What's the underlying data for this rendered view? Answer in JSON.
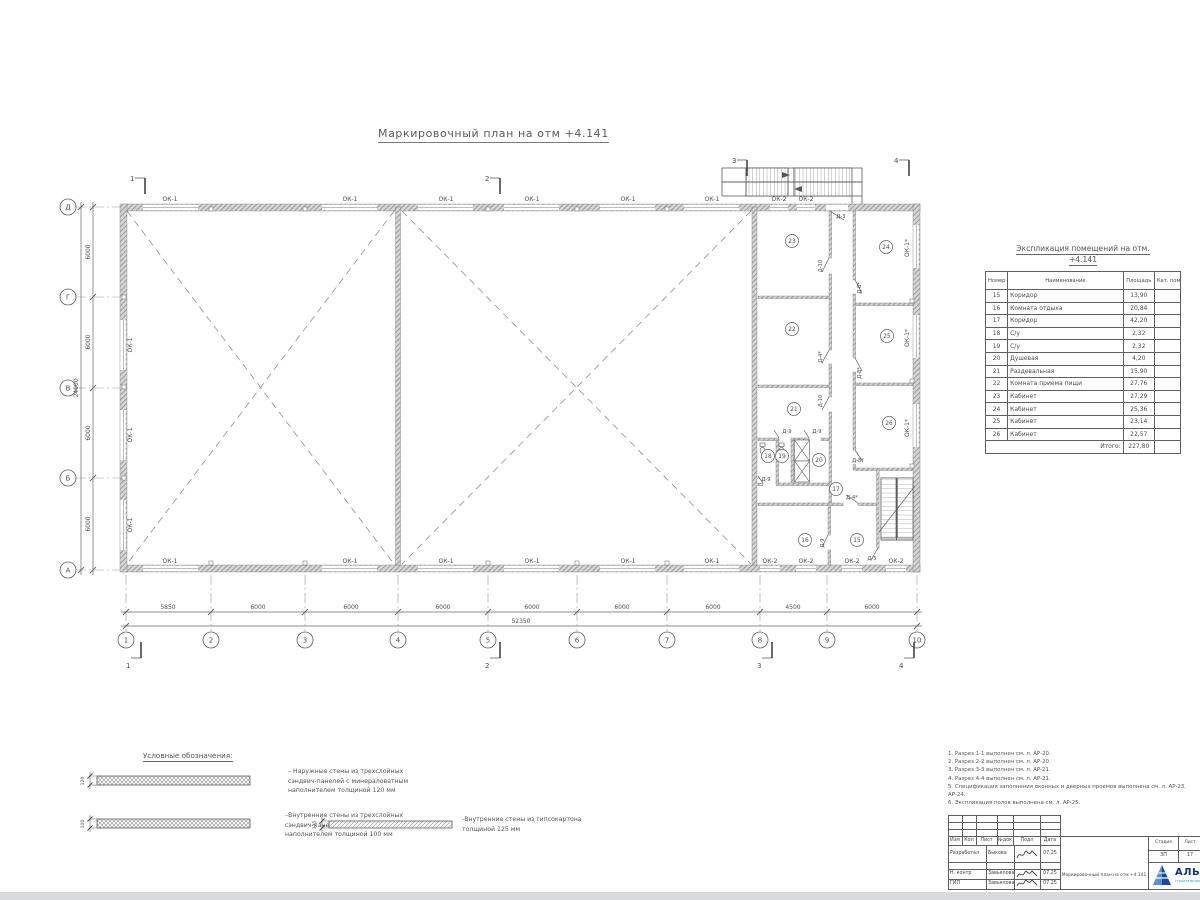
{
  "title": "Маркировочный план на отм +4.141",
  "plan": {
    "axis_rows": [
      "Д",
      "Г",
      "В",
      "Б",
      "А"
    ],
    "axis_cols": [
      "1",
      "2",
      "3",
      "4",
      "5",
      "6",
      "7",
      "8",
      "9",
      "10"
    ],
    "dims_bottom": [
      "5850",
      "6000",
      "6000",
      "6000",
      "6000",
      "6000",
      "6000",
      "4500",
      "6000"
    ],
    "dim_total_bottom": "52350",
    "dims_left": [
      "6000",
      "6000",
      "6000",
      "6000"
    ],
    "dim_total_left": "24000",
    "sections": [
      "1",
      "2",
      "3",
      "4"
    ],
    "window_labels": {
      "ok1": "ОК-1",
      "ok2": "ОК-2",
      "ok1s": "ОК-1*"
    },
    "door_labels": {
      "d3": "Д-3",
      "d4": "Д-4*",
      "d5": "Д-5",
      "d8": "Д-8*",
      "d9": "Д-9",
      "d10": "Д-10"
    },
    "rooms": [
      "15",
      "16",
      "17",
      "18",
      "19",
      "20",
      "21",
      "22",
      "23",
      "24",
      "25",
      "26"
    ]
  },
  "explication": {
    "title_line1": "Экспликация помещений на отм.",
    "title_line2": "+4.141",
    "headers": [
      "Номер помещ.",
      "Наименование",
      "Площадь",
      "Кат. пом."
    ],
    "rows": [
      [
        "15",
        "Коридор",
        "13,90"
      ],
      [
        "16",
        "Комната отдыха",
        "20,84"
      ],
      [
        "17",
        "Коридор",
        "42,20"
      ],
      [
        "18",
        "С/у",
        "2,32"
      ],
      [
        "19",
        "С/у",
        "2,32"
      ],
      [
        "20",
        "Душевая",
        "4,20"
      ],
      [
        "21",
        "Раздевальная",
        "15,90"
      ],
      [
        "22",
        "Комната приема пищи",
        "27,76"
      ],
      [
        "23",
        "Кабинет",
        "27,29"
      ],
      [
        "24",
        "Кабинет",
        "25,36"
      ],
      [
        "25",
        "Кабинет",
        "23,14"
      ],
      [
        "26",
        "Кабинет",
        "22,57"
      ]
    ],
    "total_label": "Итого:",
    "total_value": "227,80"
  },
  "legend": {
    "title": "Условные обозначения:",
    "items": [
      {
        "dim": "120",
        "text": "– Наружные стены из трехслойных\nсэндвич-панелей с минераловатным\nнаполнителем толщиной 120 мм"
      },
      {
        "dim": "100",
        "text": "–Внутренние стены из трехслойных\nсэндвич-панелей с минераловатным\nнаполнителем толщиной 100 мм"
      },
      {
        "dim": "125",
        "text": "-Внутренние стены из гипсокартона\nтолщиной 125 мм"
      }
    ]
  },
  "notes": [
    "1. Разрез 1-1 выполнен см. л. АР-20.",
    "2. Разрез 2-2 выполнен см. л. АР-20.",
    "3. Разрез 3-3 выполнен см. л. АР-21.",
    "4. Разрез 4-4 выполнен см. л. АР-21.",
    "5. Спецификация заполнения оконных и дверных проемов выполнена см. л. АР-23, АР-24.",
    "6. Экспликация полов выполнена см. л. АР-25."
  ],
  "titleblock": {
    "header_cols": [
      "Изм",
      "Кол",
      "Лист",
      "№док",
      "Подп",
      "Дата"
    ],
    "rows": [
      {
        "role": "Разработал",
        "name": "Быкова",
        "date": "07.25"
      },
      {
        "role": "Н. контр",
        "name": "Завьялова",
        "date": "07.25"
      },
      {
        "role": "ГИП",
        "name": "Завьялова",
        "date": "07.25"
      }
    ],
    "doc_title": "Маркировочный план на отм +4.141",
    "stage_label": "Стадия",
    "stage_value": "ЗП",
    "sheet_label": "Лист",
    "sheet_value": "17",
    "brand": "АЛЬЯНС",
    "brand_sub": "строительная компания"
  }
}
